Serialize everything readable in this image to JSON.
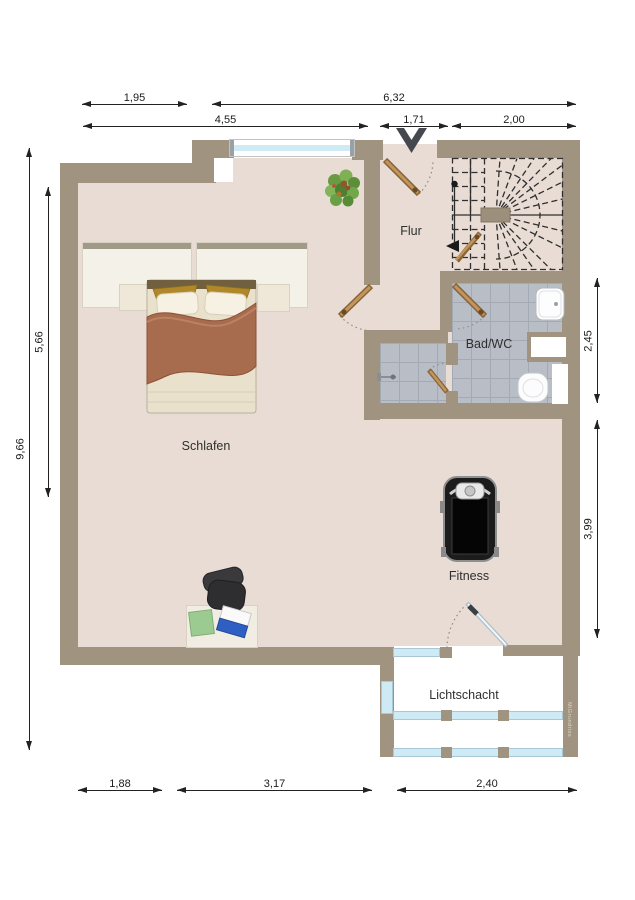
{
  "rooms": {
    "flur": "Flur",
    "bad": "Bad/WC",
    "schlafen": "Schlafen",
    "fitness": "Fitness",
    "lichtschacht": "Lichtschacht"
  },
  "dims": {
    "top1": [
      "1,95",
      "6,32"
    ],
    "top2": [
      "4,55",
      "1,71",
      "2,00"
    ],
    "left": [
      "9,66",
      "5,66"
    ],
    "right": [
      "2,45",
      "3,99"
    ],
    "bottom": [
      "1,88",
      "3,17",
      "2,40"
    ]
  },
  "watermark": "MiGrundriss",
  "colors": {
    "wall": "#a09480",
    "floor": "#e8dcd4",
    "tile": "#b9bec6",
    "window_glass": "#cdeaf5",
    "door_leaf": "#b07c4f",
    "entrance_arrow": "#45494f"
  }
}
